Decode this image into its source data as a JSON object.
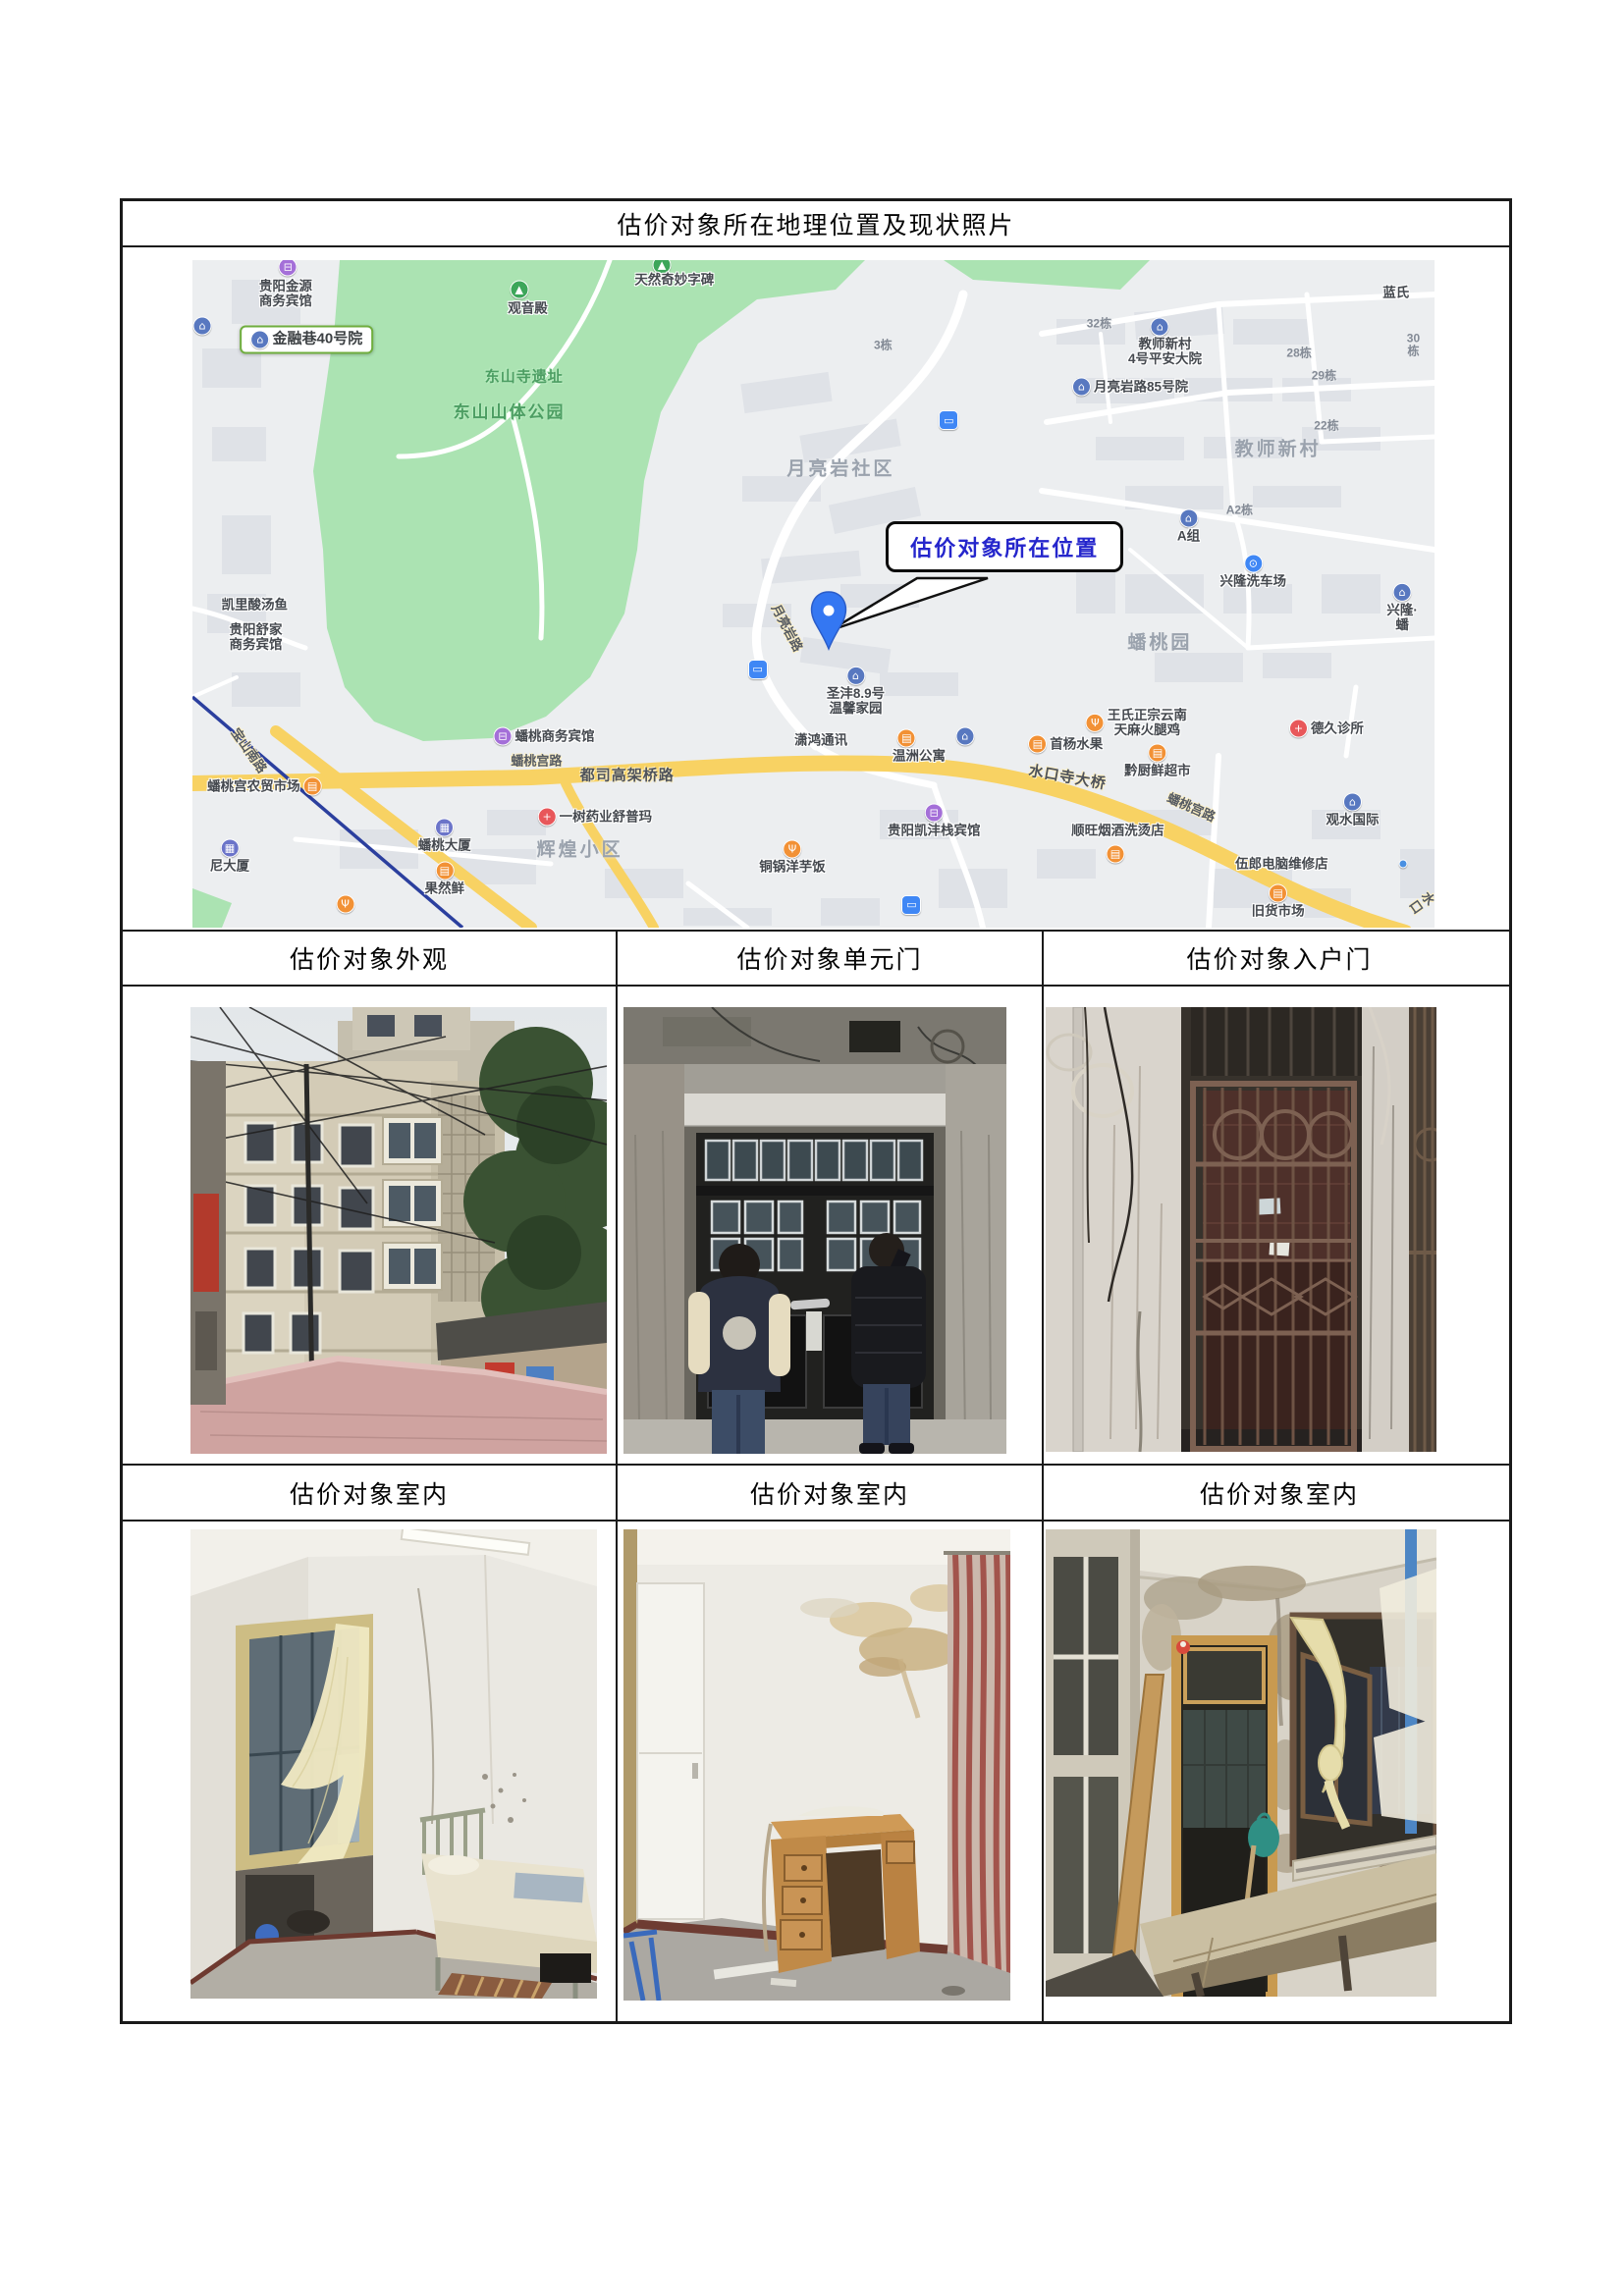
{
  "page": {
    "title": "估价对象所在地理位置及现状照片"
  },
  "table": {
    "row1_headers": [
      "估价对象外观",
      "估价对象单元门",
      "估价对象入户门"
    ],
    "row2_headers": [
      "估价对象室内",
      "估价对象室内",
      "估价对象室内"
    ]
  },
  "map": {
    "callout": {
      "text": "估价对象所在位置",
      "text_color": "#2526cc"
    },
    "colors": {
      "base": "#eceef0",
      "park": "#abe3b2",
      "road_major": "#f8d263",
      "metro_line": "#2b3f9e",
      "pin": "#3477f2",
      "highlight_border": "#6fae3e"
    },
    "icon_colors": {
      "estate": "#5878c0",
      "attraction": "#3da65a",
      "shop": "#f29135",
      "food": "#f29135",
      "hotel": "#a46fd8",
      "clinic": "#e8575a",
      "pharmacy": "#e8575a",
      "carwash": "#3f87f5",
      "bus": "#3f87f5",
      "building": "#6b74c9",
      "dot": "#4a90e2"
    },
    "icon_glyphs": {
      "estate": "⌂",
      "attraction": "▲",
      "shop": "▤",
      "food": "Ψ",
      "hotel": "⊟",
      "clinic": "+",
      "pharmacy": "+",
      "carwash": "⊙",
      "bus": "▭",
      "building": "▦",
      "dot": ""
    },
    "labels": [
      {
        "i": "hotel",
        "x": 7.7,
        "y": 1.0
      },
      {
        "t": "贵阳金源\n商务宾馆",
        "c": "poi",
        "x": 7.5,
        "y": 5.0
      },
      {
        "t": "金融巷40号院",
        "c": "hl",
        "i": "estate",
        "x": 9.2,
        "y": 11.9
      },
      {
        "i": "estate",
        "x": 0.8,
        "y": 9.9
      },
      {
        "i": "attraction",
        "x": 26.3,
        "y": 4.4
      },
      {
        "t": "观音殿",
        "c": "poi",
        "x": 27.0,
        "y": 7.2
      },
      {
        "i": "attraction",
        "x": 37.8,
        "y": 0.8
      },
      {
        "t": "天然奇妙字碑",
        "c": "poi",
        "x": 38.8,
        "y": 3.0
      },
      {
        "t": "东山寺遗址",
        "c": "park",
        "x": 26.7,
        "y": 17.6
      },
      {
        "t": "东山山体公园",
        "c": "park lg",
        "x": 25.5,
        "y": 22.8
      },
      {
        "t": "3栋",
        "c": "build",
        "x": 55.6,
        "y": 12.8
      },
      {
        "t": "32栋",
        "c": "build",
        "x": 73.0,
        "y": 9.6
      },
      {
        "i": "estate",
        "x": 77.9,
        "y": 10.0
      },
      {
        "t": "教师新村\n4号平安大院",
        "c": "poi",
        "x": 78.3,
        "y": 13.7
      },
      {
        "t": "28栋",
        "c": "build",
        "x": 89.1,
        "y": 14.0
      },
      {
        "t": "30栋",
        "c": "build",
        "x": 98.3,
        "y": 12.8
      },
      {
        "t": "蓝氏",
        "c": "poi",
        "x": 96.9,
        "y": 4.9
      },
      {
        "t": "月亮岩路85号院",
        "c": "poi",
        "i": "estate",
        "x": 75.5,
        "y": 19.0
      },
      {
        "t": "29栋",
        "c": "build",
        "x": 91.1,
        "y": 17.4
      },
      {
        "i": "bus",
        "x": 60.9,
        "y": 24.0
      },
      {
        "t": "22栋",
        "c": "build",
        "x": 91.3,
        "y": 24.9
      },
      {
        "t": "月亮岩社区",
        "c": "area",
        "x": 52.2,
        "y": 31.3
      },
      {
        "t": "教师新村",
        "c": "area",
        "x": 87.4,
        "y": 28.4
      },
      {
        "t": "A2栋",
        "c": "build",
        "x": 84.3,
        "y": 37.5
      },
      {
        "t": "A组",
        "c": "poi",
        "i": "estate",
        "p": "top",
        "x": 80.2,
        "y": 39.8
      },
      {
        "t": "兴隆洗车场",
        "c": "poi",
        "i": "carwash",
        "p": "top",
        "x": 85.4,
        "y": 46.6
      },
      {
        "t": "兴隆·蟠",
        "c": "poi",
        "i": "estate",
        "p": "top",
        "x": 97.4,
        "y": 52.0
      },
      {
        "t": "月亮岩路",
        "c": "road",
        "r": 62,
        "x": 47.8,
        "y": 55.1
      },
      {
        "i": "bus",
        "x": 45.5,
        "y": 61.3
      },
      {
        "t": "圣沣8.9号\n温馨家园",
        "c": "poi",
        "i": "estate",
        "p": "top",
        "x": 53.4,
        "y": 64.6
      },
      {
        "t": "蟠桃园",
        "c": "area",
        "x": 77.9,
        "y": 57.4
      },
      {
        "t": "王氏正宗云南\n天麻火腿鸡",
        "c": "poi",
        "i": "food",
        "x": 76.0,
        "y": 69.3
      },
      {
        "t": "德久诊所",
        "c": "poi",
        "i": "clinic",
        "x": 91.3,
        "y": 70.1
      },
      {
        "t": "首杨水果",
        "c": "poi",
        "i": "shop",
        "x": 70.3,
        "y": 72.5
      },
      {
        "t": "黔厨鲜超市",
        "c": "poi",
        "i": "shop",
        "p": "top",
        "x": 77.7,
        "y": 75.0
      },
      {
        "t": "潇鸿通讯",
        "c": "poi",
        "x": 50.6,
        "y": 71.9
      },
      {
        "i": "shop",
        "x": 57.5,
        "y": 71.6
      },
      {
        "i": "estate",
        "x": 62.2,
        "y": 71.3
      },
      {
        "t": "温洲公寓",
        "c": "poi",
        "x": 58.5,
        "y": 74.3
      },
      {
        "t": "蟠桃商务宾馆",
        "c": "poi",
        "i": "hotel",
        "x": 28.3,
        "y": 71.3
      },
      {
        "t": "蟠桃宫路",
        "c": "road",
        "x": 27.7,
        "y": 75.2
      },
      {
        "t": "都司高架桥路",
        "c": "road big",
        "x": 35.0,
        "y": 77.3
      },
      {
        "t": "水口寺大桥",
        "c": "road big",
        "r": 10,
        "x": 70.4,
        "y": 77.6
      },
      {
        "t": "蟠桃宫农贸市场",
        "c": "poi",
        "i": "shop",
        "p": "right",
        "x": 5.8,
        "y": 78.8
      },
      {
        "t": "蟠桃宫路",
        "c": "road",
        "r": 24,
        "x": 80.4,
        "y": 82.0
      },
      {
        "t": "一树药业舒普玛",
        "c": "poi",
        "i": "pharmacy",
        "x": 32.4,
        "y": 83.4
      },
      {
        "t": "贵阳凯沣栈宾馆",
        "c": "poi",
        "i": "hotel",
        "p": "top",
        "x": 59.7,
        "y": 84.0
      },
      {
        "t": "顺旺烟酒洗烫店",
        "c": "poi",
        "x": 74.5,
        "y": 85.4
      },
      {
        "i": "shop",
        "x": 74.3,
        "y": 89.0
      },
      {
        "t": "观水国际",
        "c": "poi",
        "i": "estate",
        "p": "top",
        "x": 93.4,
        "y": 82.4
      },
      {
        "t": "辉煌小区",
        "c": "area",
        "x": 31.2,
        "y": 88.4
      },
      {
        "t": "铜锅洋芋饭",
        "c": "poi",
        "i": "food",
        "p": "top",
        "x": 48.3,
        "y": 89.4
      },
      {
        "t": "蟠桃大厦",
        "c": "poi",
        "i": "building",
        "p": "top",
        "x": 20.3,
        "y": 86.2
      },
      {
        "t": "尼大厦",
        "c": "poi",
        "i": "building",
        "p": "top",
        "x": 3.0,
        "y": 89.2
      },
      {
        "t": "果然鲜",
        "c": "poi",
        "i": "shop",
        "p": "top",
        "x": 20.3,
        "y": 92.6
      },
      {
        "t": "伍郎电脑维修店",
        "c": "poi",
        "x": 87.7,
        "y": 90.4
      },
      {
        "i": "dot",
        "x": 97.5,
        "y": 90.4
      },
      {
        "t": "旧货市场",
        "c": "poi",
        "i": "shop",
        "p": "top",
        "x": 87.4,
        "y": 96.0
      },
      {
        "t": "水口",
        "c": "road",
        "r": 55,
        "x": 99.0,
        "y": 96.3
      },
      {
        "t": "凯里酸汤鱼",
        "c": "poi",
        "x": 5.0,
        "y": 51.6
      },
      {
        "t": "贵阳舒家\n商务宾馆",
        "c": "poi",
        "x": 5.1,
        "y": 56.5
      },
      {
        "t": "宝山南路",
        "c": "road",
        "r": 55,
        "x": 4.5,
        "y": 73.5
      },
      {
        "i": "bus",
        "x": 57.9,
        "y": 96.6
      },
      {
        "i": "food",
        "x": 12.3,
        "y": 96.5
      }
    ]
  }
}
